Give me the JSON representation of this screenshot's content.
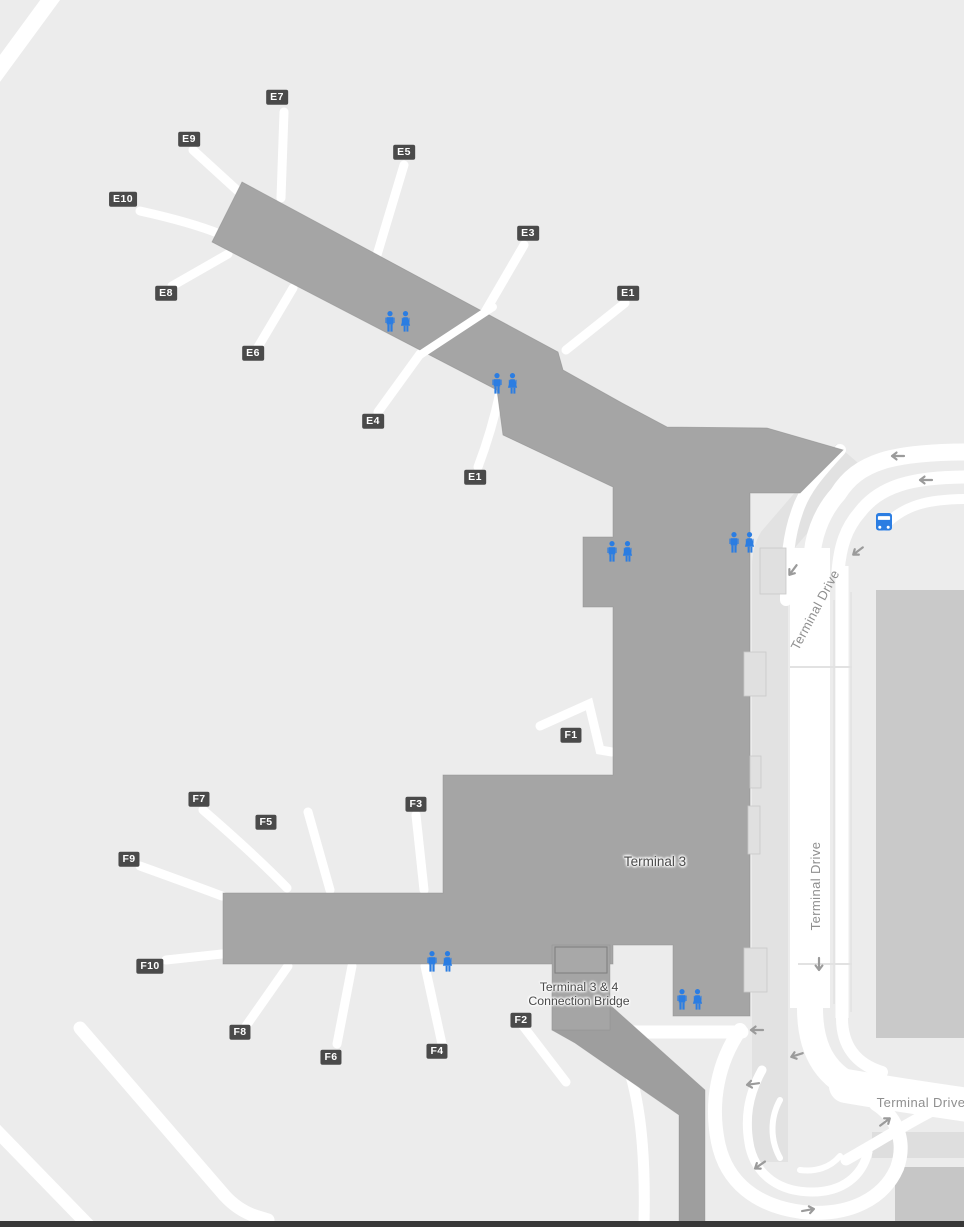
{
  "map": {
    "terminal": {
      "label": "Terminal 3"
    },
    "bridge": {
      "label_line1": "Terminal 3 & 4",
      "label_line2": "Connection Bridge"
    },
    "roads": {
      "labels": [
        {
          "text": "Terminal Drive",
          "x": 819,
          "y": 612,
          "rotate": -62
        },
        {
          "text": "Terminal Drive",
          "x": 820,
          "y": 886,
          "rotate": -90
        },
        {
          "text": "Terminal Drive",
          "x": 921,
          "y": 1107,
          "rotate": 0
        }
      ]
    },
    "gates": [
      {
        "id": "E7",
        "x": 277,
        "y": 97
      },
      {
        "id": "E9",
        "x": 189,
        "y": 139
      },
      {
        "id": "E10",
        "x": 123,
        "y": 199
      },
      {
        "id": "E8",
        "x": 166,
        "y": 293
      },
      {
        "id": "E6",
        "x": 253,
        "y": 353
      },
      {
        "id": "E5",
        "x": 404,
        "y": 152
      },
      {
        "id": "E3",
        "x": 528,
        "y": 233
      },
      {
        "id": "E1",
        "x": 628,
        "y": 293
      },
      {
        "id": "E4",
        "x": 373,
        "y": 421
      },
      {
        "id": "E1",
        "x": 475,
        "y": 477
      },
      {
        "id": "F1",
        "x": 571,
        "y": 735
      },
      {
        "id": "F7",
        "x": 199,
        "y": 799
      },
      {
        "id": "F5",
        "x": 266,
        "y": 822
      },
      {
        "id": "F3",
        "x": 416,
        "y": 804
      },
      {
        "id": "F9",
        "x": 129,
        "y": 859
      },
      {
        "id": "F10",
        "x": 150,
        "y": 966
      },
      {
        "id": "F8",
        "x": 240,
        "y": 1032
      },
      {
        "id": "F6",
        "x": 331,
        "y": 1057
      },
      {
        "id": "F4",
        "x": 437,
        "y": 1051
      },
      {
        "id": "F2",
        "x": 521,
        "y": 1020
      }
    ],
    "restrooms": [
      {
        "x": 398,
        "y": 322
      },
      {
        "x": 505,
        "y": 384
      },
      {
        "x": 620,
        "y": 552
      },
      {
        "x": 742,
        "y": 543
      },
      {
        "x": 440,
        "y": 962
      },
      {
        "x": 690,
        "y": 1000
      }
    ],
    "poi": {
      "bus_stop": {
        "x": 884,
        "y": 522
      }
    },
    "arrows": [
      {
        "x": 898,
        "y": 456,
        "rot": 0
      },
      {
        "x": 926,
        "y": 480,
        "rot": 0
      },
      {
        "x": 858,
        "y": 551,
        "rot": -37
      },
      {
        "x": 793,
        "y": 570,
        "rot": -53
      },
      {
        "x": 819,
        "y": 964,
        "rot": -90
      },
      {
        "x": 757,
        "y": 1030,
        "rot": 0
      },
      {
        "x": 797,
        "y": 1055,
        "rot": -18
      },
      {
        "x": 753,
        "y": 1084,
        "rot": -8
      },
      {
        "x": 760,
        "y": 1165,
        "rot": -35
      },
      {
        "x": 808,
        "y": 1210,
        "rot": 170
      },
      {
        "x": 885,
        "y": 1122,
        "rot": 143
      }
    ],
    "colors": {
      "background": "#ececec",
      "terminal_fill": "#a5a5a5",
      "bridge_fill": "#9e9e9e",
      "road": "#ffffff",
      "garage": "#c9c9c9",
      "walkway": "#e2e2e2",
      "badge_bg": "#4a4a4a",
      "badge_text": "#ffffff",
      "accent_blue": "#2b7de2",
      "road_label": "#8f8f8f",
      "bottom_border": "#383838"
    }
  }
}
